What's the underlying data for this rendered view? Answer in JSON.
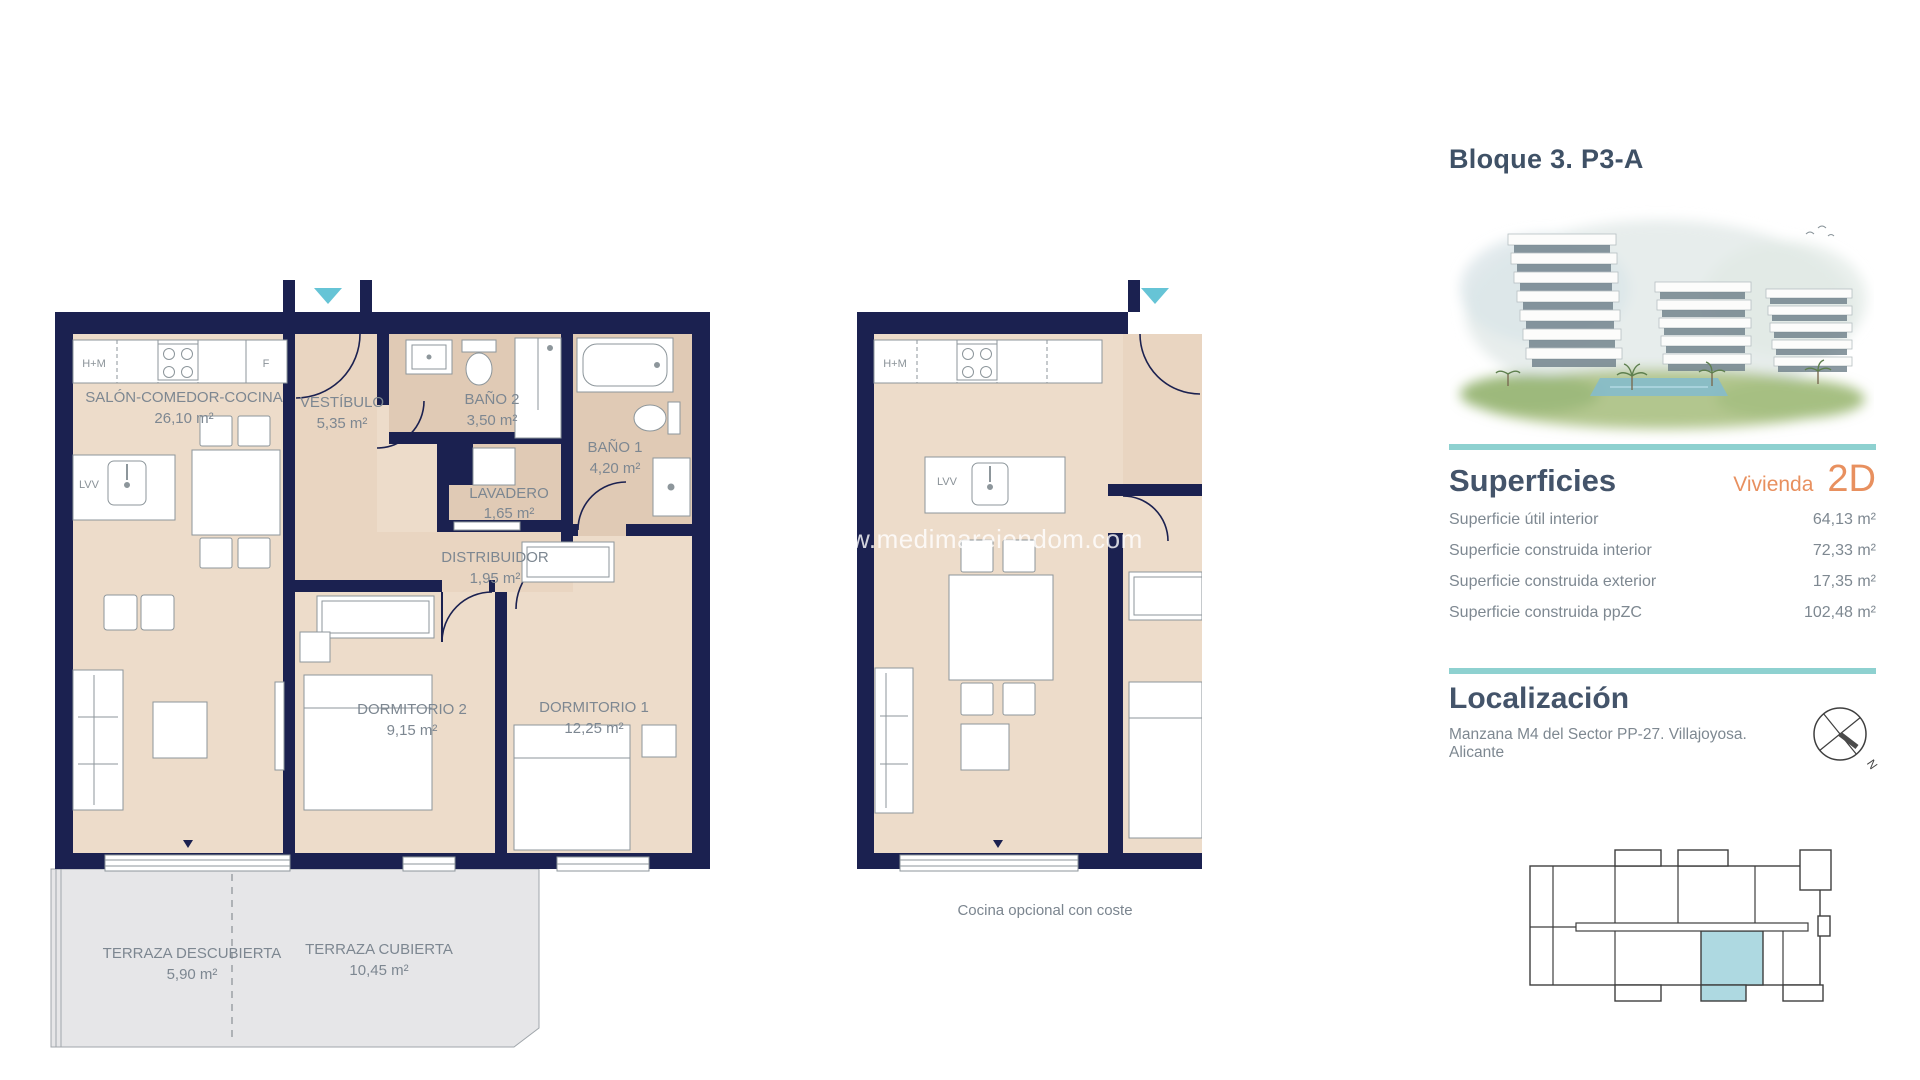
{
  "plan_main": {
    "rooms": [
      {
        "name": "SALÓN-COMEDOR-COCINA",
        "area": "26,10 m²"
      },
      {
        "name": "VESTÍBULO",
        "area": "5,35 m²"
      },
      {
        "name": "BAÑO 2",
        "area": "3,50 m²"
      },
      {
        "name": "BAÑO 1",
        "area": "4,20 m²"
      },
      {
        "name": "LAVADERO",
        "area": "1,65 m²"
      },
      {
        "name": "DISTRIBUIDOR",
        "area": "1,95 m²"
      },
      {
        "name": "DORMITORIO 2",
        "area": "9,15 m²"
      },
      {
        "name": "DORMITORIO 1",
        "area": "12,25 m²"
      },
      {
        "name": "TERRAZA DESCUBIERTA",
        "area": "5,90 m²"
      },
      {
        "name": "TERRAZA CUBIERTA",
        "area": "10,45 m²"
      }
    ],
    "kitchen": {
      "hm": "H+M",
      "f": "F",
      "lvv": "LVV"
    }
  },
  "plan_optional": {
    "kitchen": {
      "hm": "H+M",
      "lvv": "LVV"
    },
    "caption": "Cocina opcional con coste"
  },
  "watermark": {
    "text": "w.medimareiendom.com"
  },
  "panel": {
    "title": "Bloque 3. P3-A",
    "superficies": {
      "heading": "Superficies",
      "vivienda_label": "Vivienda",
      "unit": "2D",
      "rows": [
        {
          "label": "Superficie útil interior",
          "value": "64,13 m²"
        },
        {
          "label": "Superficie construida interior",
          "value": "72,33 m²"
        },
        {
          "label": "Superficie construida exterior",
          "value": "17,35 m²"
        },
        {
          "label": "Superficie construida ppZC",
          "value": "102,48 m²"
        }
      ]
    },
    "localizacion": {
      "heading": "Localización",
      "address": "Manzana M4 del Sector PP-27. Villajoyosa. Alicante",
      "compass_n": "N"
    }
  },
  "colors": {
    "wall_navy": "#1b2150",
    "floor_beige": "#eddcca",
    "floor_wet": "#e0cab5",
    "terrace_gray": "#e6e6e8",
    "accent_teal": "#8ed1d0",
    "arrow_teal": "#66c4d6",
    "heading_slate": "#44546a",
    "accent_orange": "#e8905f",
    "highlight_unit": "#aed9e1"
  }
}
